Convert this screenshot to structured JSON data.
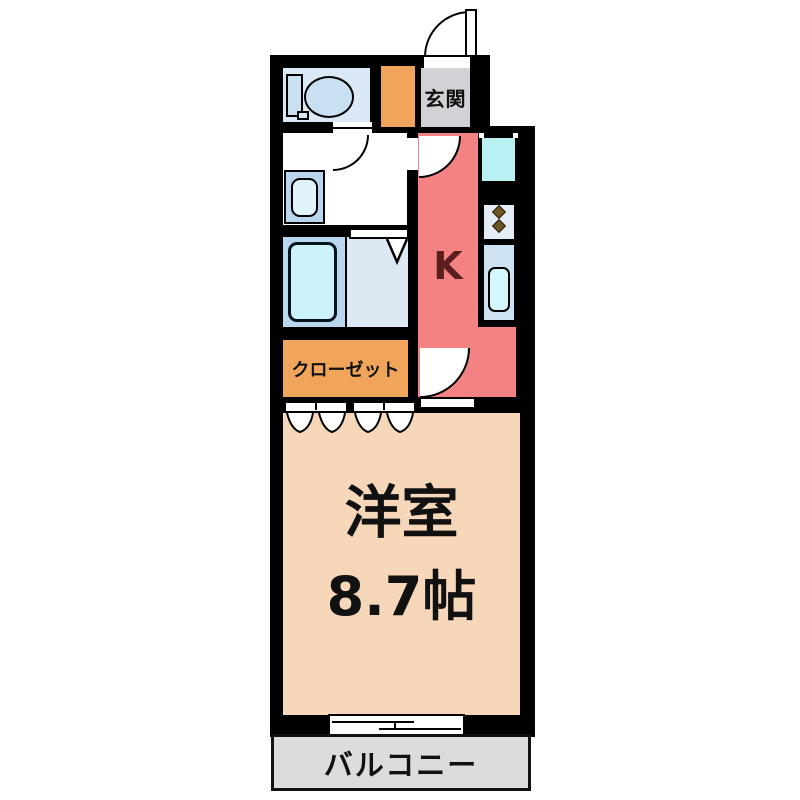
{
  "floor_plan": {
    "rooms": {
      "genkan": {
        "label": "玄関"
      },
      "kitchen": {
        "label": "K"
      },
      "closet": {
        "label": "クローゼット"
      },
      "main_room": {
        "name": "洋室",
        "size": "8.7帖"
      },
      "balcony": {
        "label": "バルコニー"
      }
    },
    "colors": {
      "wall": "#000000",
      "kitchen": "#f48282",
      "kitchen_label": "#5b1e1e",
      "closet": "#f0a55a",
      "main_room": "#f6d7b9",
      "balcony": "#dcdcdc",
      "genkan": "#d4d1d6",
      "toilet_room": "#dbe9f7",
      "bathroom": "#b9d8f0",
      "shower_room": "#dce8f4",
      "fixture_cyan": "#c9f2f8",
      "text": "#111111"
    }
  }
}
